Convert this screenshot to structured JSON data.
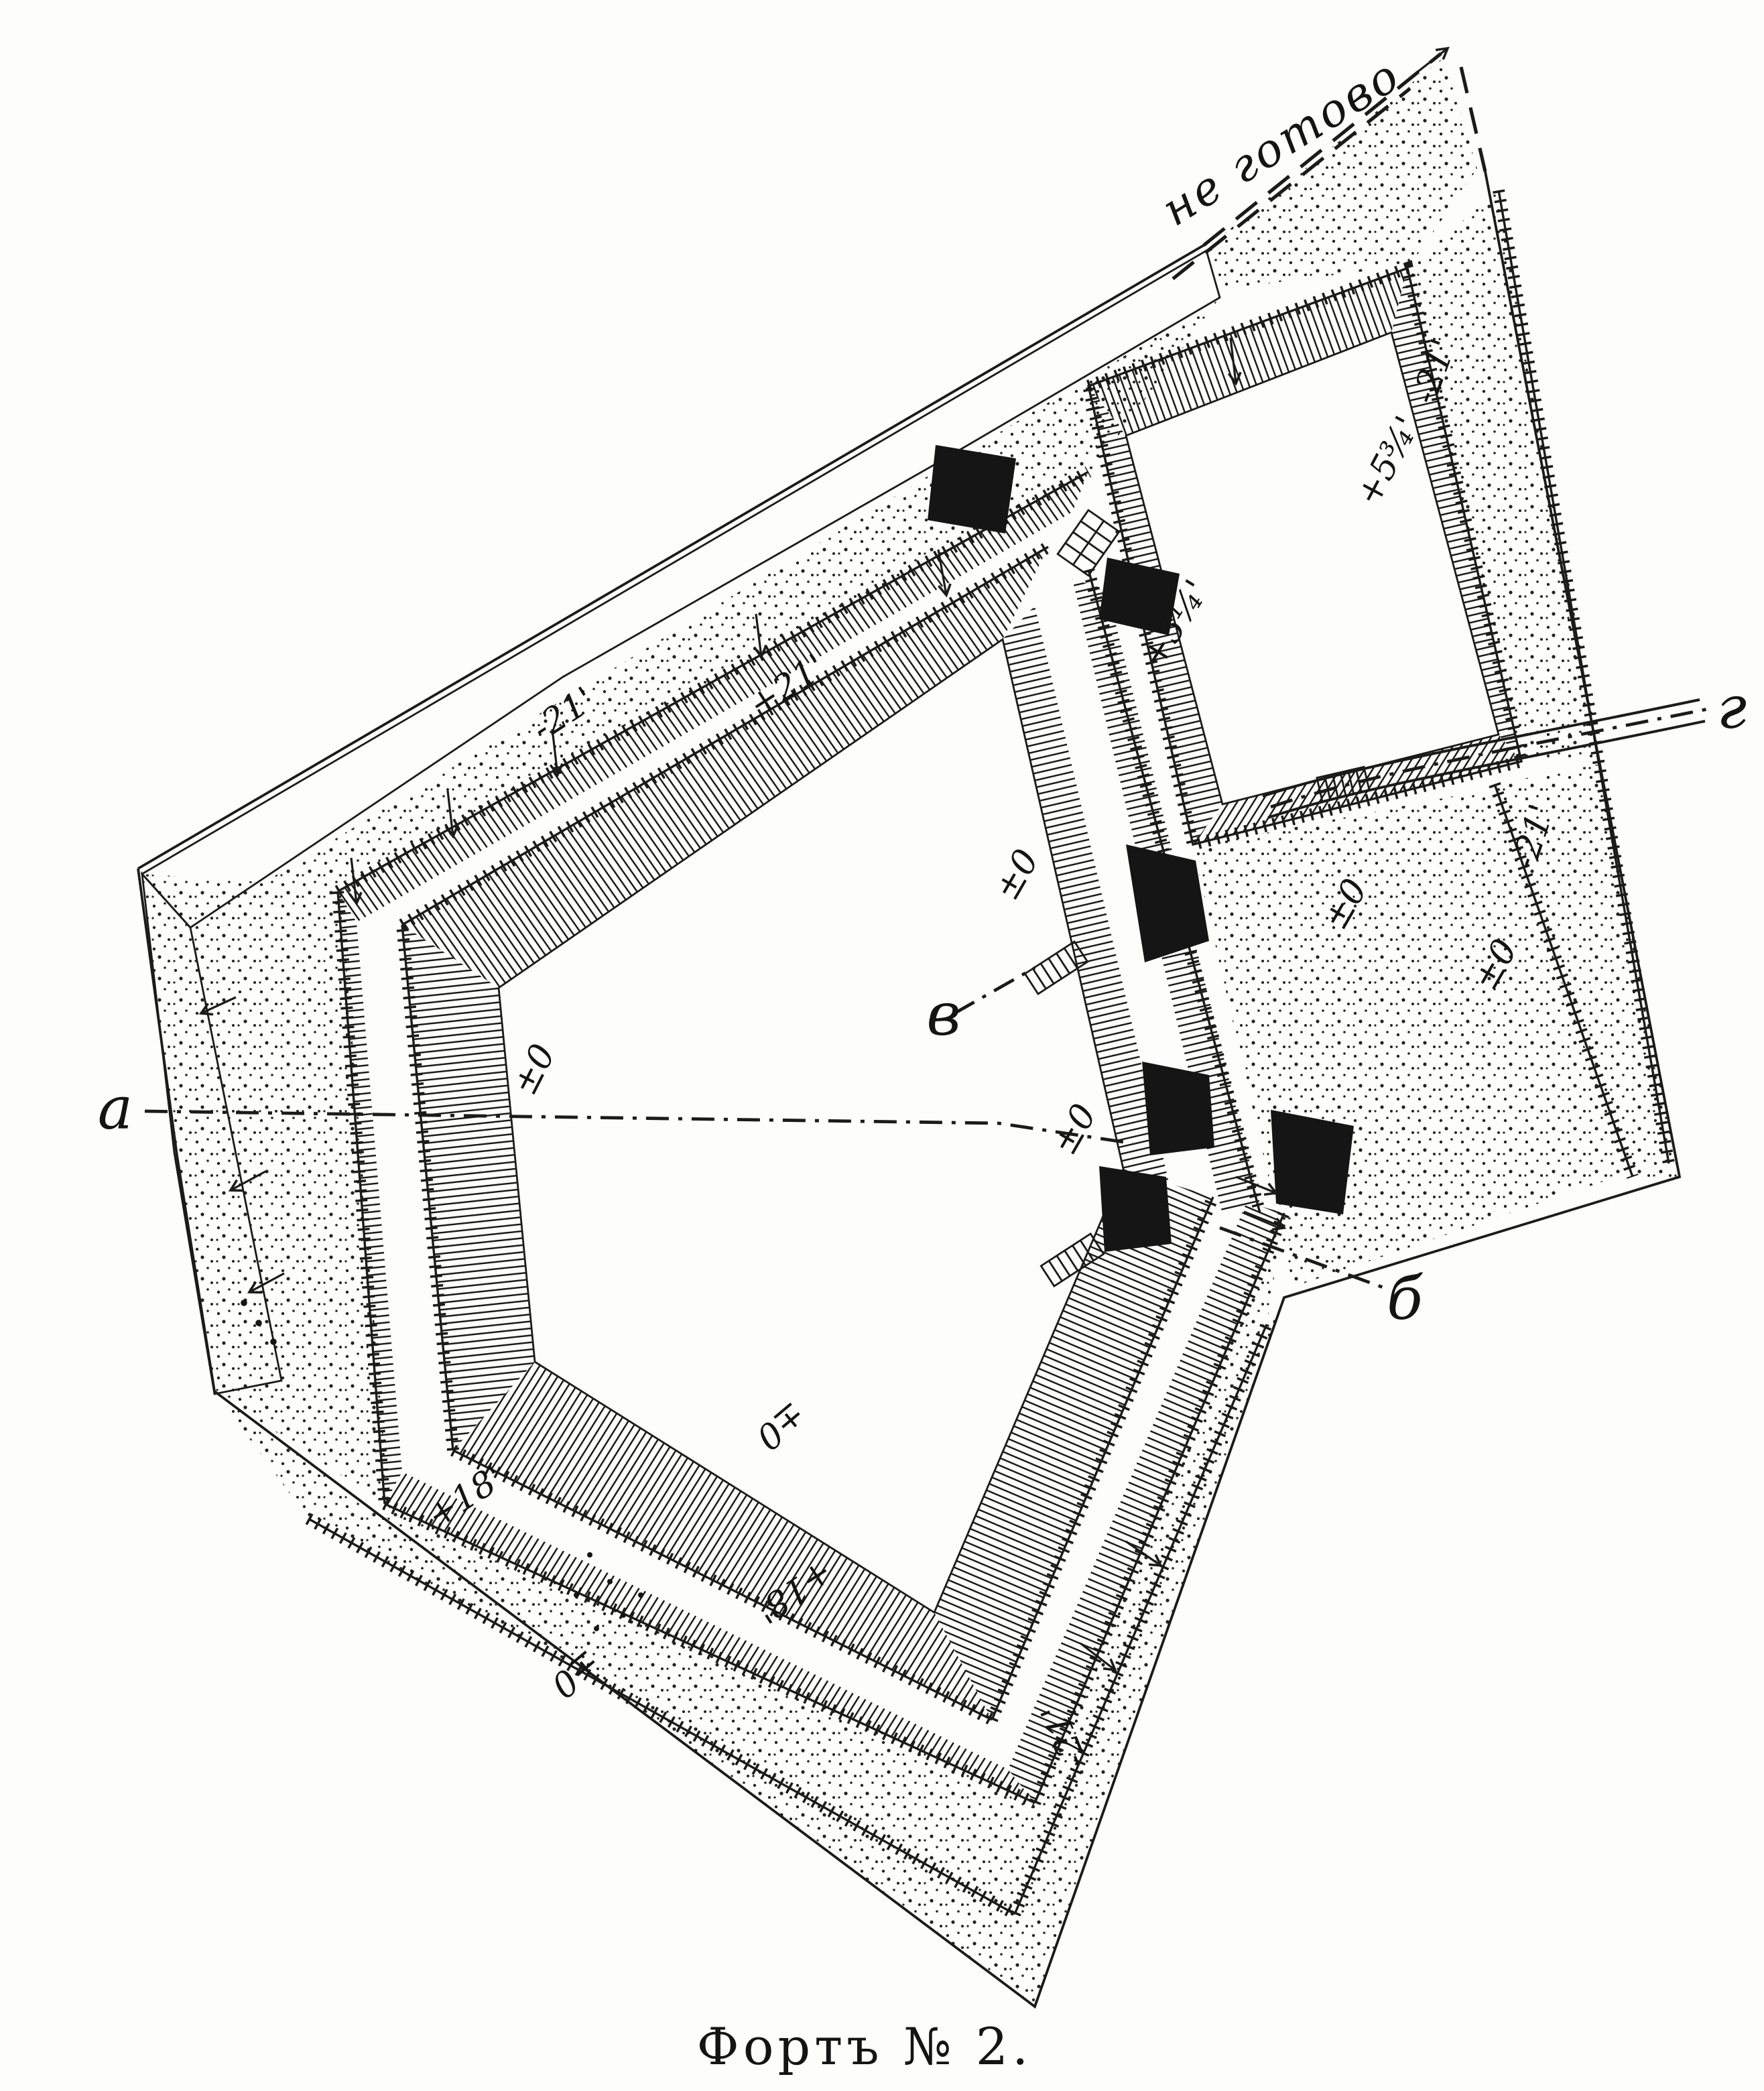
{
  "caption": "Фортъ № 2.",
  "annotations": {
    "unfinished_note": "не готово",
    "section_letters": {
      "a": "а",
      "b": "б",
      "v": "в",
      "g": "г"
    }
  },
  "elevation_marks": {
    "glacis_nw": "-21'",
    "rampart_nw": "+21'",
    "redoubt_ditch_ne": "-21'",
    "redoubt_interior": "+5¾'",
    "gorge_upper": "+5¼'",
    "east_ditch": "-21'",
    "parade_west": "±0",
    "parade_center": "±0",
    "gorge_north": "±0",
    "bridge_east": "±0",
    "outwork_field": "±0",
    "covered_way_south": "±0",
    "glacis_sw_corner": "±0",
    "covered_way_sw_upper": "+18'",
    "covered_way_sw_lower": "+18'",
    "ditch_se": "-21'"
  },
  "colors": {
    "ink": "#1b1b1b",
    "paper": "#fdfdfb"
  }
}
